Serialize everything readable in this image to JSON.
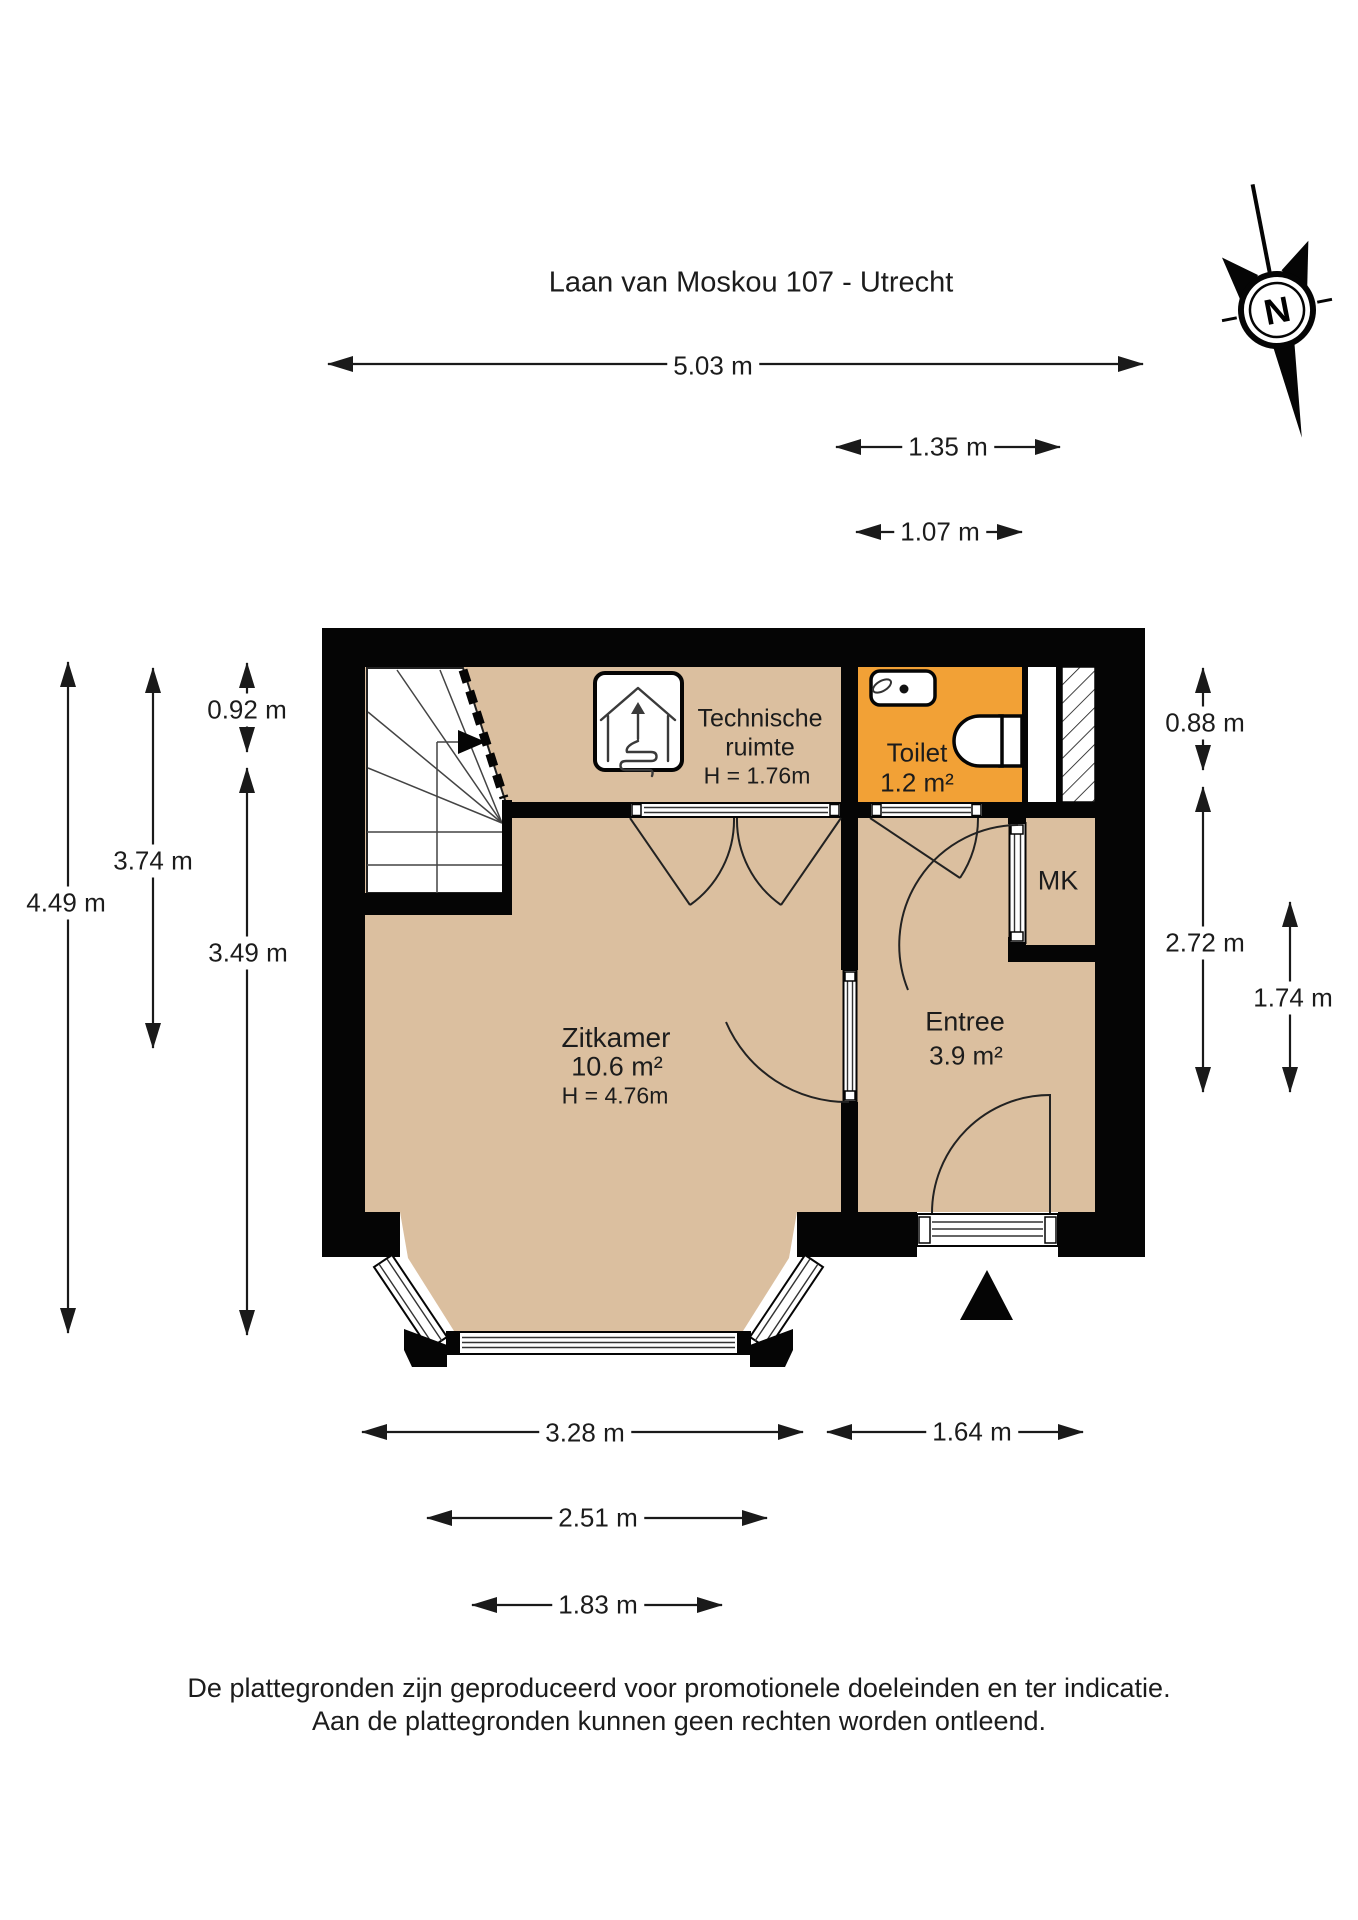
{
  "title": "Laan van Moskou 107 - Utrecht",
  "compass": {
    "label": "N"
  },
  "rooms": {
    "technische": {
      "line1": "Technische",
      "line2": "ruimte",
      "height": "H = 1.76m"
    },
    "toilet": {
      "label": "Toilet",
      "area": "1.2 m²"
    },
    "mk": {
      "label": "MK"
    },
    "zitkamer": {
      "label": "Zitkamer",
      "area": "10.6 m²",
      "height": "H = 4.76m"
    },
    "entree": {
      "label": "Entree",
      "area": "3.9 m²"
    }
  },
  "dimensions": {
    "d503": "5.03 m",
    "d135": "1.35 m",
    "d107": "1.07 m",
    "d449": "4.49 m",
    "d374": "3.74 m",
    "d092": "0.92 m",
    "d349": "3.49 m",
    "d088": "0.88 m",
    "d272": "2.72 m",
    "d174": "1.74 m",
    "d328": "3.28 m",
    "d164": "1.64 m",
    "d251": "2.51 m",
    "d183": "1.83 m"
  },
  "footer": {
    "line1": "De plattegronden zijn geproduceerd voor promotionele doeleinden en ter indicatie.",
    "line2": "Aan de plattegronden kunnen geen rechten worden ontleend."
  },
  "colors": {
    "floor": "#DBBF9F",
    "wet_room": "#F2A136",
    "wall": "#050505",
    "line": "#1a1a1a"
  }
}
